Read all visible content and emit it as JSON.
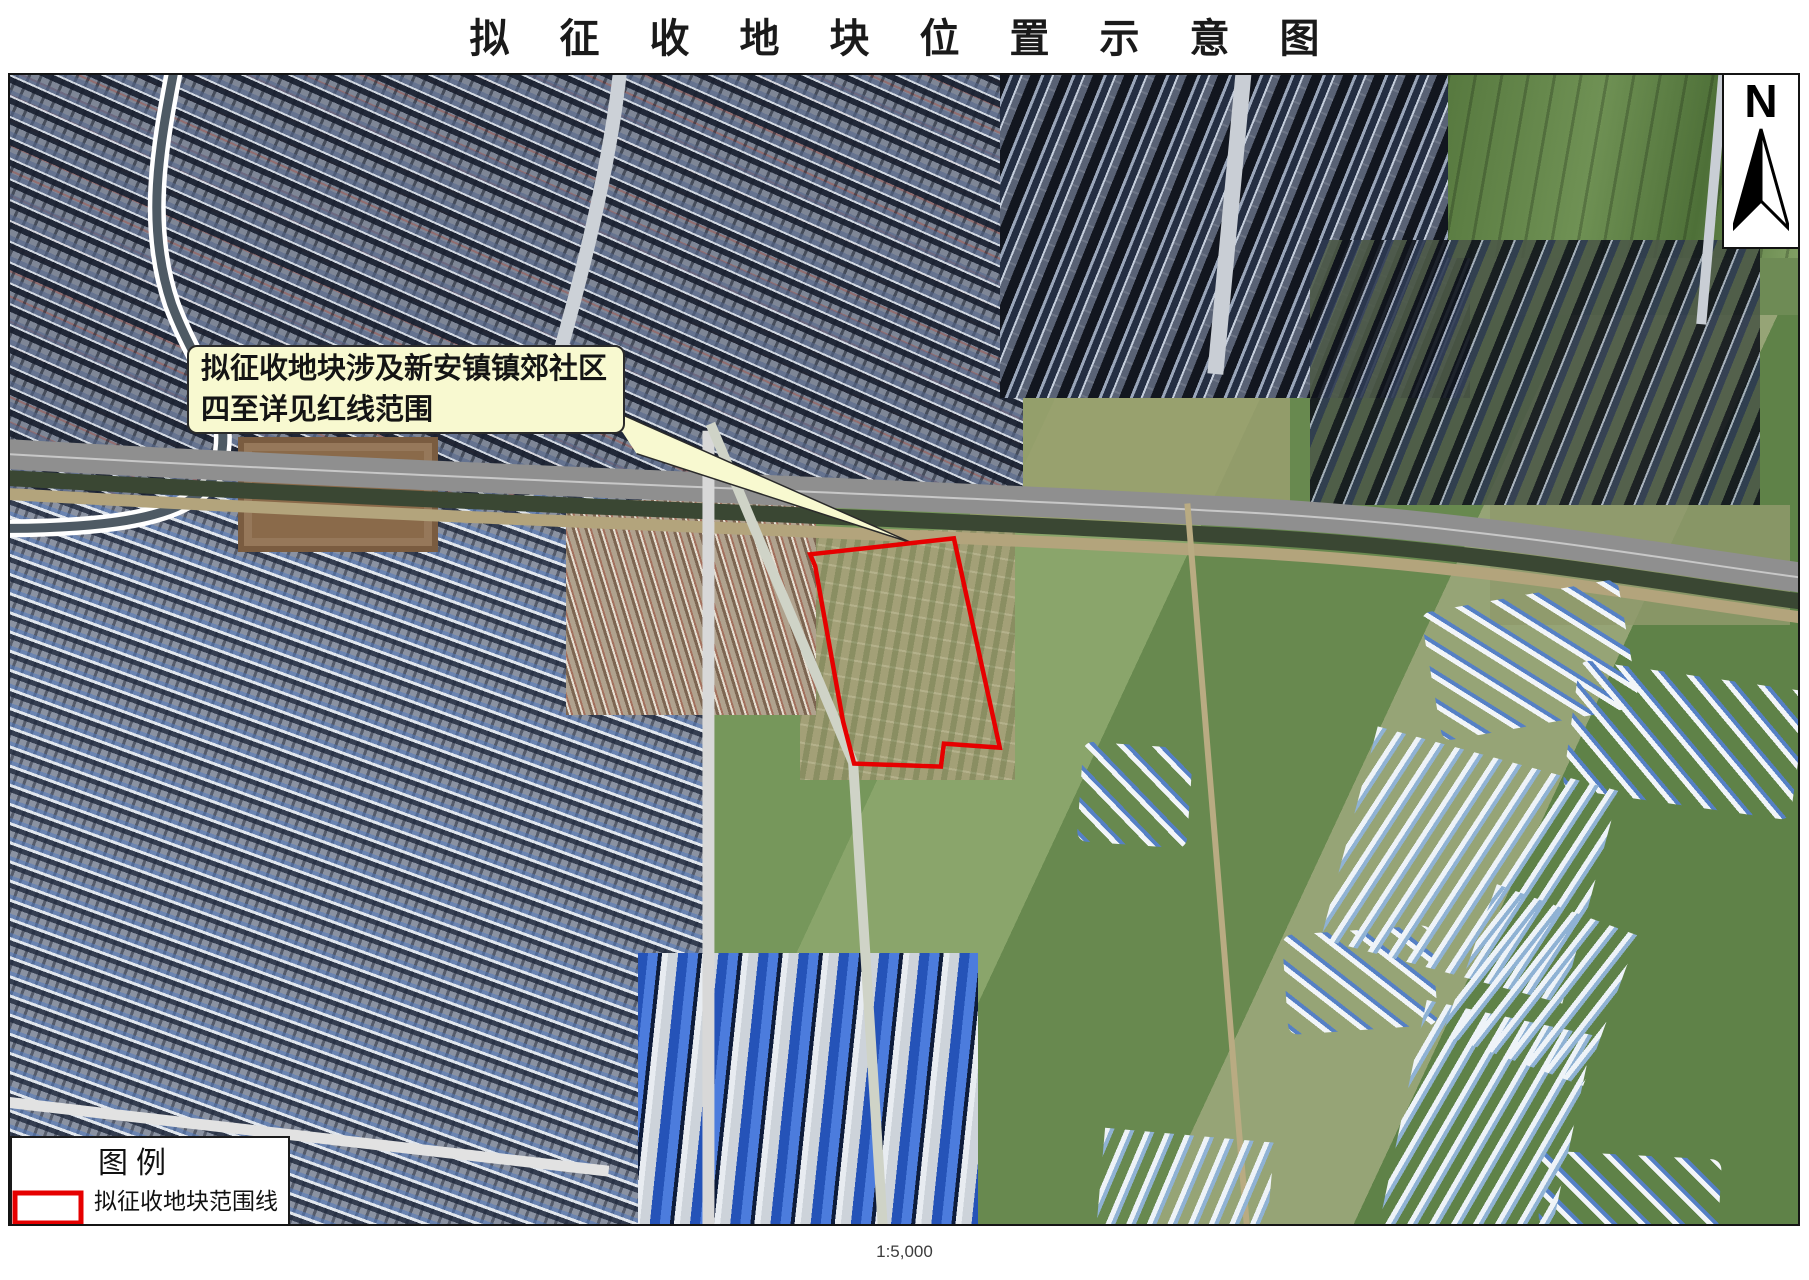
{
  "page": {
    "title": "拟 征 收 地 块 位 置 示 意 图",
    "scale_label": "1:5,000"
  },
  "map": {
    "callout": {
      "line1": "拟征收地块涉及新安镇镇郊社区",
      "line2": "四至详见红线范围",
      "background_color": "#f8f9d0"
    },
    "north_arrow_label": "N",
    "parcel": {
      "outline_color": "#e60000"
    },
    "legend": {
      "title": "图例",
      "items": [
        {
          "label": "拟征收地块范围线",
          "swatch_outline_color": "#e60000"
        }
      ]
    }
  }
}
